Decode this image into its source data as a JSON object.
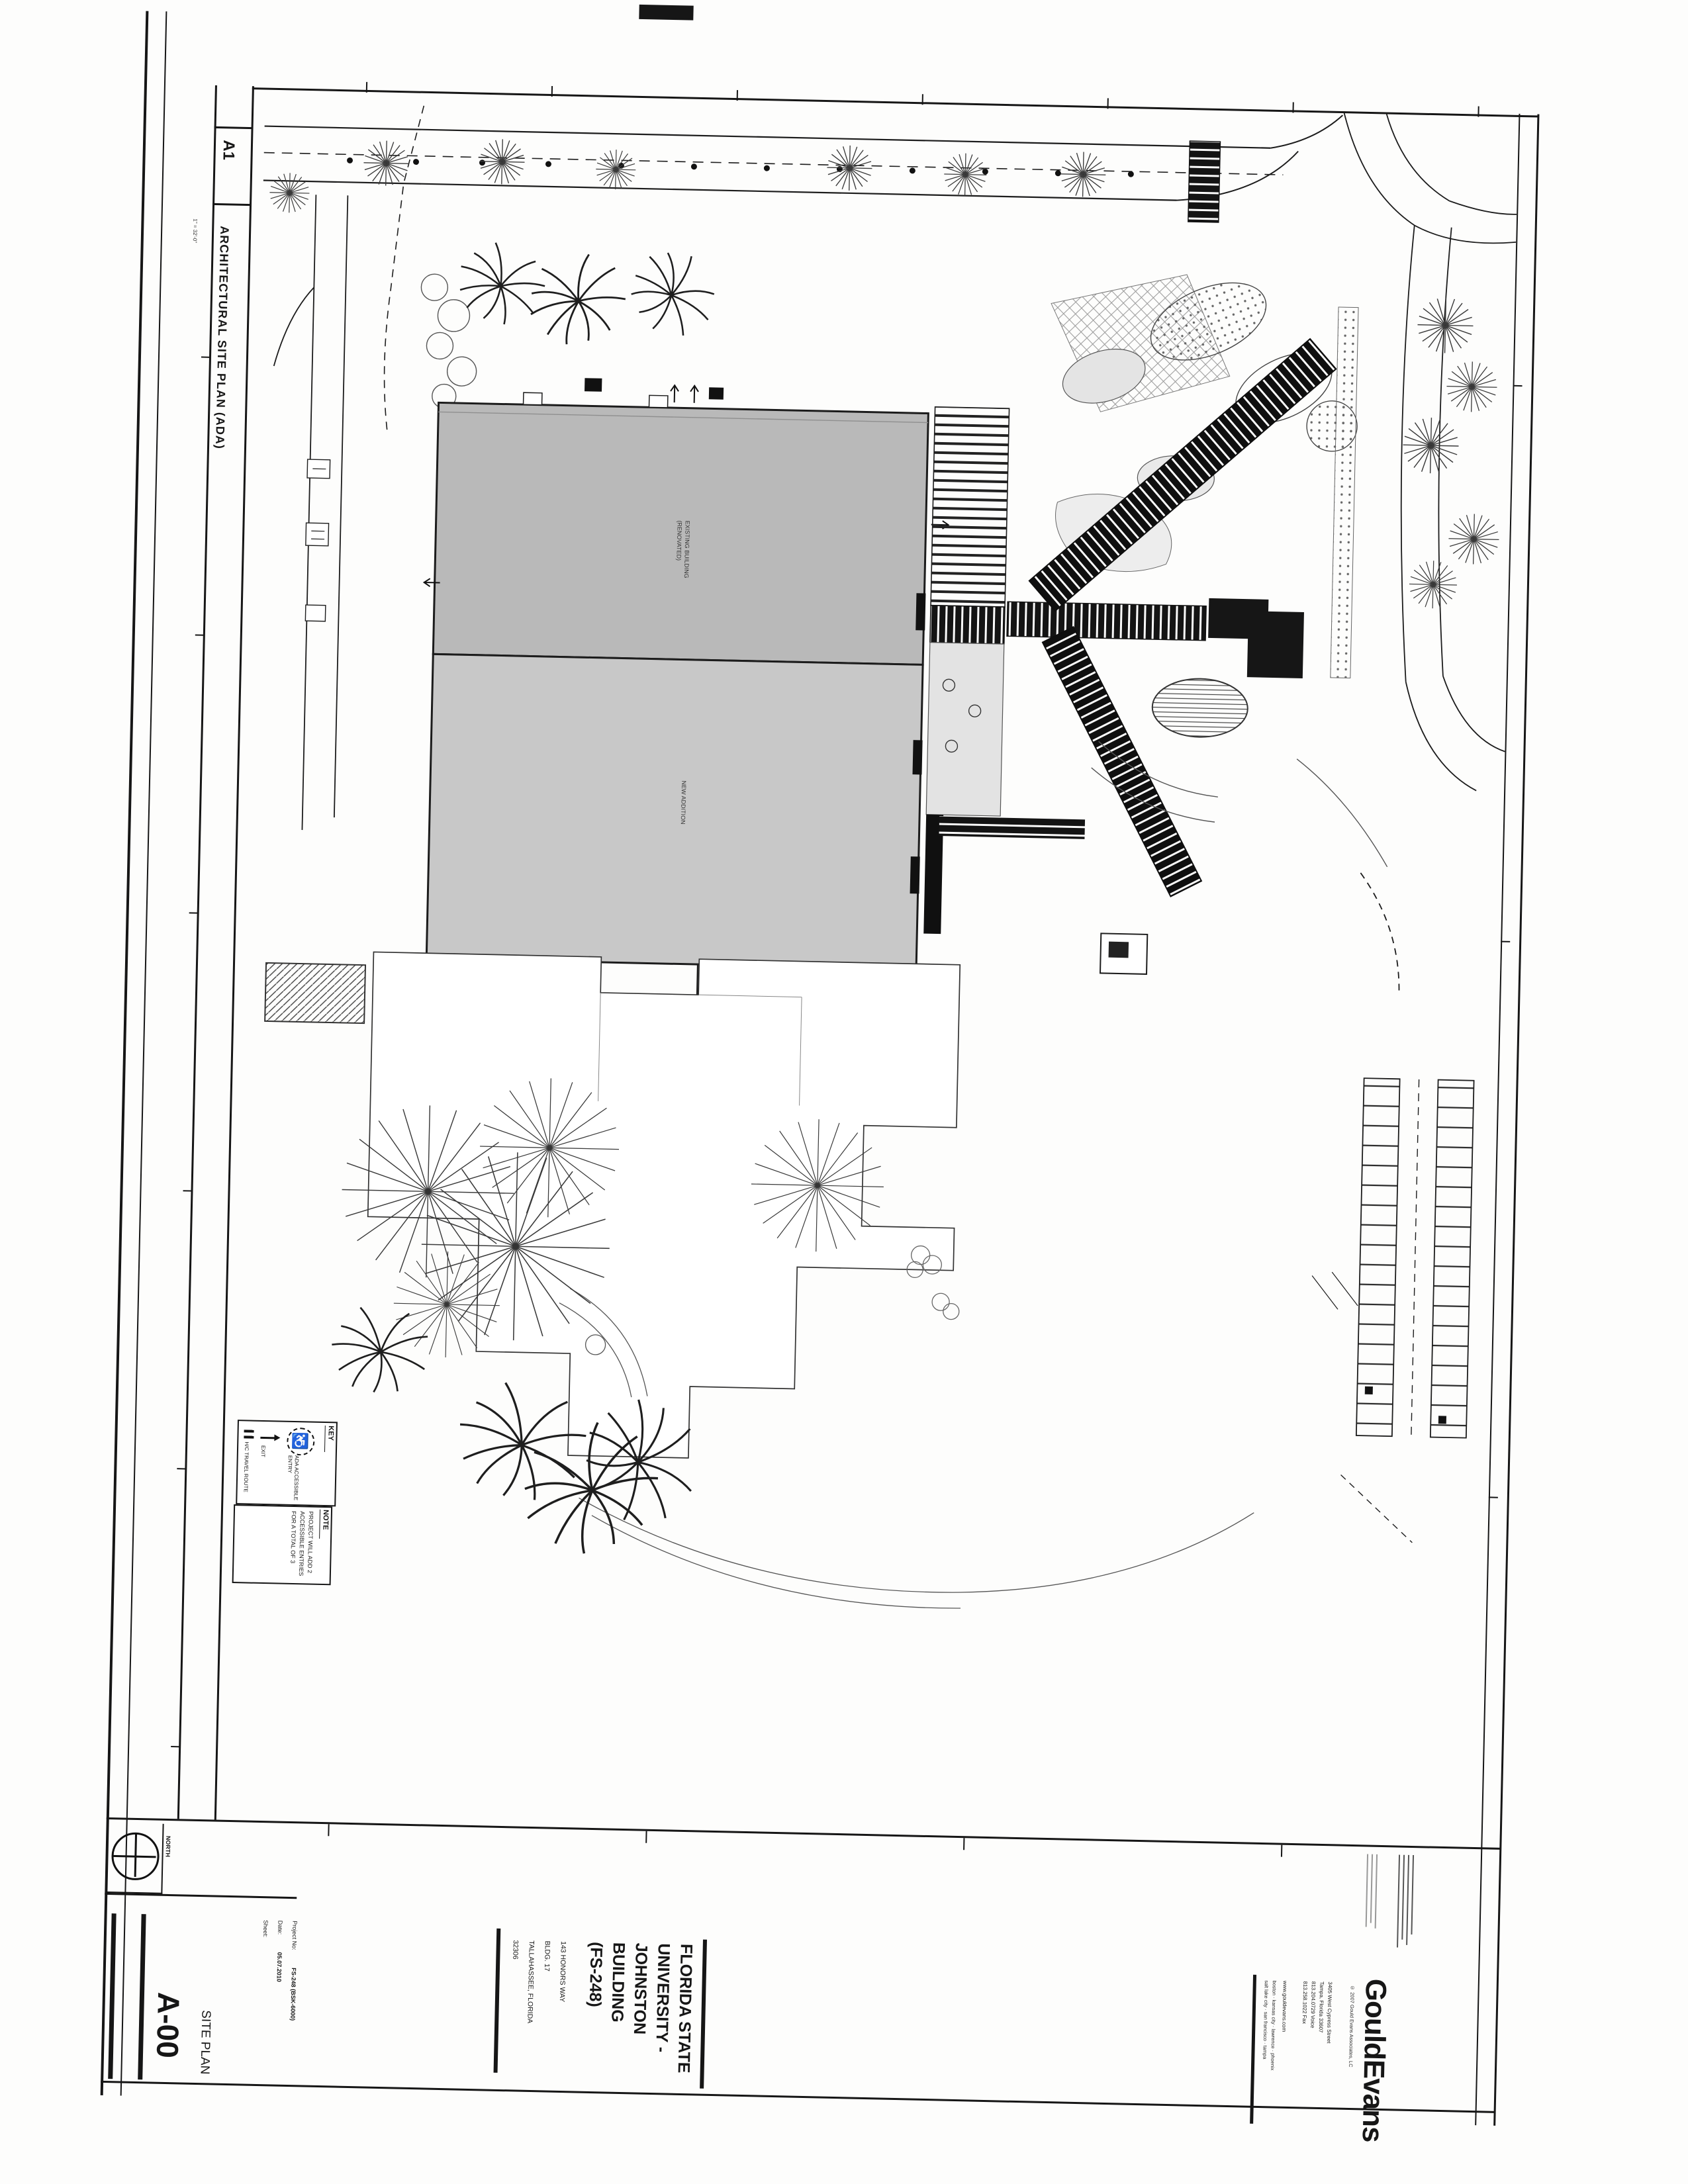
{
  "sheet": {
    "drawing_ref": "A1",
    "drawing_title": "ARCHITECTURAL SITE PLAN (ADA)",
    "drawing_scale": "1\" = 32'-0\"",
    "plan_labels": {
      "existing_line1": "EXISTING BUILDING",
      "existing_line2": "(RENOVATED)",
      "new_addition": "NEW ADDITION"
    },
    "key": {
      "title": "KEY",
      "items": [
        {
          "icon": "travel-route-dashes",
          "label": "H/C TRAVEL ROUTE"
        },
        {
          "icon": "exit-arrow",
          "label": "EXIT"
        },
        {
          "icon": "ada-wheelchair",
          "label": "ADA ACCESSIBLE ENTRY"
        }
      ]
    },
    "note": {
      "title": "NOTE",
      "lines": [
        "PROJECT WILL ADD 2",
        "ACCESSIBLE ENTRIES",
        "FOR A TOTAL OF 3"
      ]
    },
    "title_block": {
      "north_label": "NORTH",
      "sheet_number": "A-00",
      "sheet_title": "SITE PLAN",
      "fields": [
        {
          "label": "Project No:",
          "value": "FS-248 (BSK-6000)"
        },
        {
          "label": "Date:",
          "value": "05.07.2010"
        },
        {
          "label": "Sheet:",
          "value": ""
        }
      ],
      "project_name_lines": [
        "FLORIDA STATE",
        "UNIVERSITY -",
        "JOHNSTON",
        "BUILDING",
        "(FS-248)"
      ],
      "project_address_lines": [
        "143 HONORS WAY",
        "BLDG. 17",
        "TALLAHASSEE, FLORIDA",
        "32306"
      ],
      "firm": {
        "logo": "GouldEvans",
        "copyright": "© 2007 Gould Evans Associates, LC",
        "address_lines": [
          "3405 West Cypress Street",
          "Tampa, Florida 33607",
          "813.204.0729 Voice",
          "813.258.1022 Fax"
        ],
        "website": "www.gouldevans.com",
        "offices_lines": [
          "boston · kansas city · lawrence · phoenix",
          "salt lake city · san francisco · tampa"
        ]
      }
    },
    "colors": {
      "ink": "#161616",
      "existing_fill": "#b9b9b9",
      "addition_fill": "#c8c8c8",
      "paper": "#fdfdfc"
    }
  }
}
